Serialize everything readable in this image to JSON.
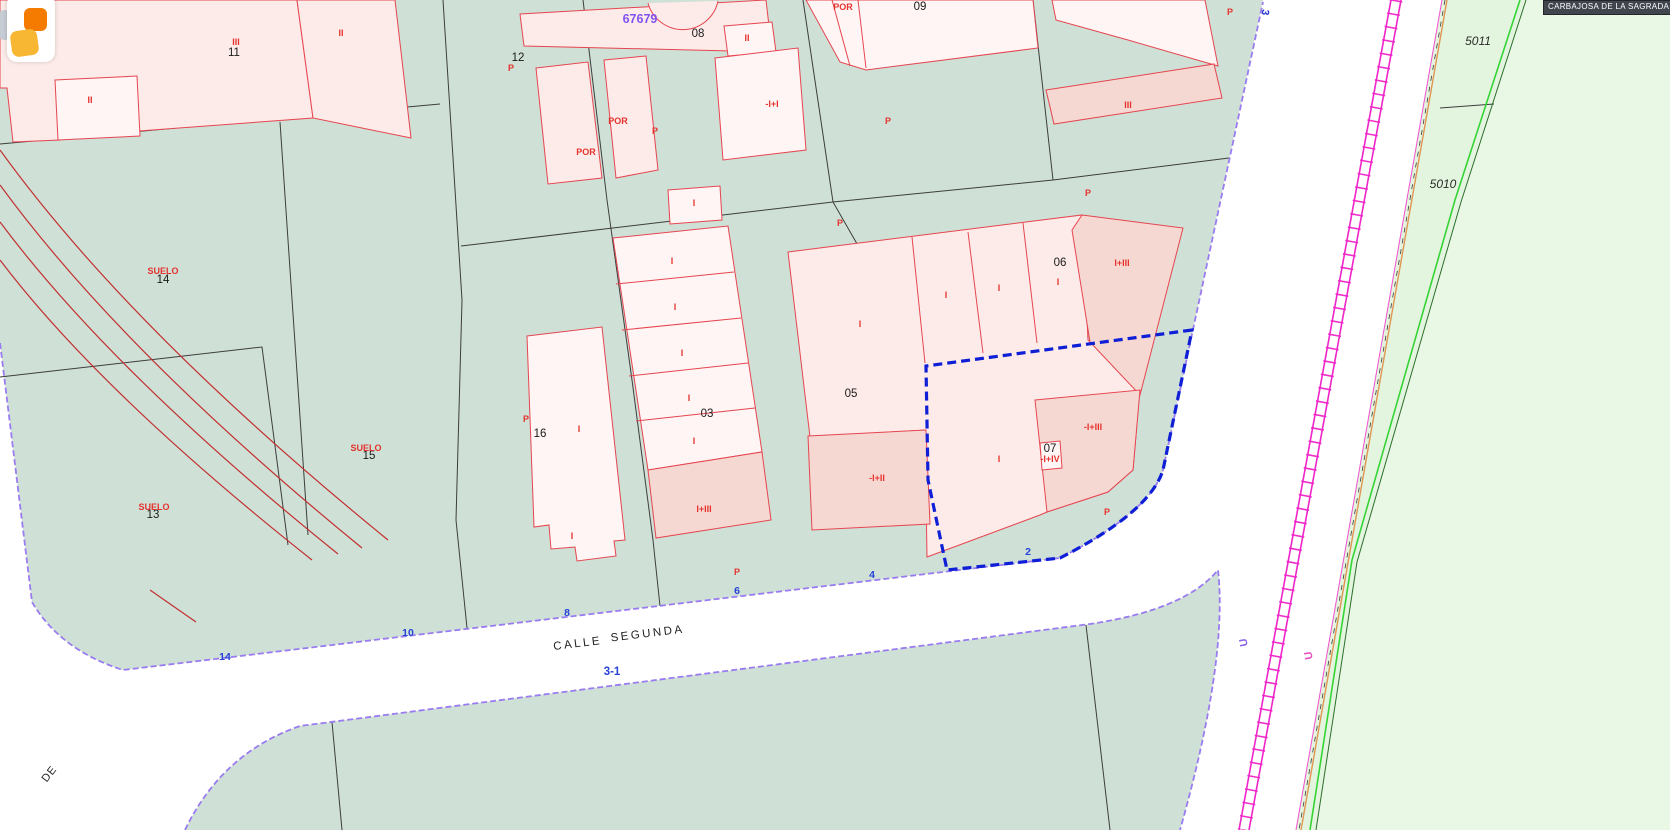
{
  "municipality": "CARBAJOSA DE LA SAGRADA",
  "street_name": "CALLE SEGUNDA",
  "block_number": "67679",
  "selected_parcel_house_number": "2",
  "colors": {
    "teal": "#cfe0d6",
    "rural": "#e9f8e5",
    "rural2": "#e4f5df",
    "building_light": "#fcebe8",
    "building_lighter": "#fef5f4",
    "building_dark": "#f6d8d2",
    "building_stroke": "#e64550",
    "street_edge": "#9a7cf0",
    "selection_blue": "#0f1fd6",
    "railway_magenta": "#f024c8",
    "green_line": "#35d435",
    "red_label": "#e5322e",
    "blue_label": "#2743d8",
    "violet_label": "#8153f0"
  },
  "labels": [
    {
      "t": "11",
      "x": 234,
      "y": 56,
      "k": "pn"
    },
    {
      "t": "12",
      "x": 518,
      "y": 61,
      "k": "pn"
    },
    {
      "t": "08",
      "x": 698,
      "y": 37,
      "k": "pn"
    },
    {
      "t": "09",
      "x": 920,
      "y": 10,
      "k": "pn"
    },
    {
      "t": "03",
      "x": 707,
      "y": 417,
      "k": "pn"
    },
    {
      "t": "05",
      "x": 851,
      "y": 397,
      "k": "pn"
    },
    {
      "t": "06",
      "x": 1060,
      "y": 266,
      "k": "pn"
    },
    {
      "t": "07",
      "x": 1050,
      "y": 452,
      "k": "pn"
    },
    {
      "t": "16",
      "x": 540,
      "y": 437,
      "k": "pn"
    },
    {
      "t": "14",
      "x": 163,
      "y": 283,
      "k": "pn"
    },
    {
      "t": "15",
      "x": 369,
      "y": 459,
      "k": "pn"
    },
    {
      "t": "13",
      "x": 153,
      "y": 518,
      "k": "pn"
    },
    {
      "t": "5011",
      "x": 1478,
      "y": 45,
      "k": "rustic"
    },
    {
      "t": "5010",
      "x": 1443,
      "y": 188,
      "k": "rustic"
    },
    {
      "t": "67679",
      "x": 640,
      "y": 23,
      "k": "violet"
    },
    {
      "t": "III",
      "x": 236,
      "y": 45,
      "k": "red"
    },
    {
      "t": "II",
      "x": 90,
      "y": 103,
      "k": "red"
    },
    {
      "t": "II",
      "x": 341,
      "y": 36,
      "k": "red"
    },
    {
      "t": "II",
      "x": 747,
      "y": 41,
      "k": "red"
    },
    {
      "t": "P",
      "x": 511,
      "y": 71,
      "k": "red"
    },
    {
      "t": "POR",
      "x": 618,
      "y": 124,
      "k": "red"
    },
    {
      "t": "POR",
      "x": 586,
      "y": 155,
      "k": "red"
    },
    {
      "t": "P",
      "x": 655,
      "y": 134,
      "k": "red"
    },
    {
      "t": "-I+I",
      "x": 772,
      "y": 107,
      "k": "red"
    },
    {
      "t": "POR",
      "x": 843,
      "y": 10,
      "k": "red"
    },
    {
      "t": "P",
      "x": 888,
      "y": 124,
      "k": "red"
    },
    {
      "t": "III",
      "x": 1128,
      "y": 108,
      "k": "red"
    },
    {
      "t": "P",
      "x": 1230,
      "y": 15,
      "k": "red"
    },
    {
      "t": "P",
      "x": 1088,
      "y": 196,
      "k": "red"
    },
    {
      "t": "P",
      "x": 840,
      "y": 226,
      "k": "red"
    },
    {
      "t": "I",
      "x": 694,
      "y": 206,
      "k": "red"
    },
    {
      "t": "I",
      "x": 672,
      "y": 264,
      "k": "red"
    },
    {
      "t": "I",
      "x": 675,
      "y": 310,
      "k": "red"
    },
    {
      "t": "I",
      "x": 682,
      "y": 356,
      "k": "red"
    },
    {
      "t": "I",
      "x": 689,
      "y": 401,
      "k": "red"
    },
    {
      "t": "I",
      "x": 694,
      "y": 444,
      "k": "red"
    },
    {
      "t": "I",
      "x": 579,
      "y": 432,
      "k": "red"
    },
    {
      "t": "P",
      "x": 526,
      "y": 422,
      "k": "red"
    },
    {
      "t": "I+III",
      "x": 704,
      "y": 512,
      "k": "red"
    },
    {
      "t": "I",
      "x": 572,
      "y": 539,
      "k": "red"
    },
    {
      "t": "I",
      "x": 860,
      "y": 327,
      "k": "red"
    },
    {
      "t": "I",
      "x": 946,
      "y": 298,
      "k": "red"
    },
    {
      "t": "I",
      "x": 999,
      "y": 291,
      "k": "red"
    },
    {
      "t": "I",
      "x": 1058,
      "y": 285,
      "k": "red"
    },
    {
      "t": "I+III",
      "x": 1122,
      "y": 266,
      "k": "red"
    },
    {
      "t": "-I+II",
      "x": 877,
      "y": 481,
      "k": "red"
    },
    {
      "t": "I",
      "x": 999,
      "y": 462,
      "k": "red"
    },
    {
      "t": "-I+IV",
      "x": 1050,
      "y": 462,
      "k": "red"
    },
    {
      "t": "-I+III",
      "x": 1093,
      "y": 430,
      "k": "red"
    },
    {
      "t": "P",
      "x": 1107,
      "y": 515,
      "k": "red"
    },
    {
      "t": "P",
      "x": 737,
      "y": 575,
      "k": "red"
    },
    {
      "t": "SUELO",
      "x": 163,
      "y": 274,
      "k": "red"
    },
    {
      "t": "SUELO",
      "x": 366,
      "y": 451,
      "k": "red"
    },
    {
      "t": "SUELO",
      "x": 154,
      "y": 510,
      "k": "red"
    },
    {
      "t": "14",
      "x": 225,
      "y": 660,
      "k": "blue"
    },
    {
      "t": "10",
      "x": 408,
      "y": 636,
      "k": "blue"
    },
    {
      "t": "8",
      "x": 567,
      "y": 616,
      "k": "blue"
    },
    {
      "t": "6",
      "x": 737,
      "y": 594,
      "k": "blue"
    },
    {
      "t": "4",
      "x": 872,
      "y": 578,
      "k": "blue"
    },
    {
      "t": "2",
      "x": 1028,
      "y": 555,
      "k": "blue"
    },
    {
      "t": "3-1",
      "x": 612,
      "y": 675,
      "k": "blue-lg"
    },
    {
      "t": "CALLE",
      "x": 578,
      "y": 647,
      "k": "street",
      "r": -7
    },
    {
      "t": "SEGUNDA",
      "x": 648,
      "y": 637,
      "k": "street",
      "r": -7
    },
    {
      "t": "DE",
      "x": 52,
      "y": 776,
      "k": "de",
      "r": -52
    },
    {
      "t": "U",
      "x": 1247,
      "y": 642,
      "k": "u1",
      "r": -100
    },
    {
      "t": "U",
      "x": 1312,
      "y": 655,
      "k": "u2",
      "r": -100
    },
    {
      "t": "3",
      "x": 1262,
      "y": 12,
      "k": "b3",
      "r": 95
    }
  ]
}
